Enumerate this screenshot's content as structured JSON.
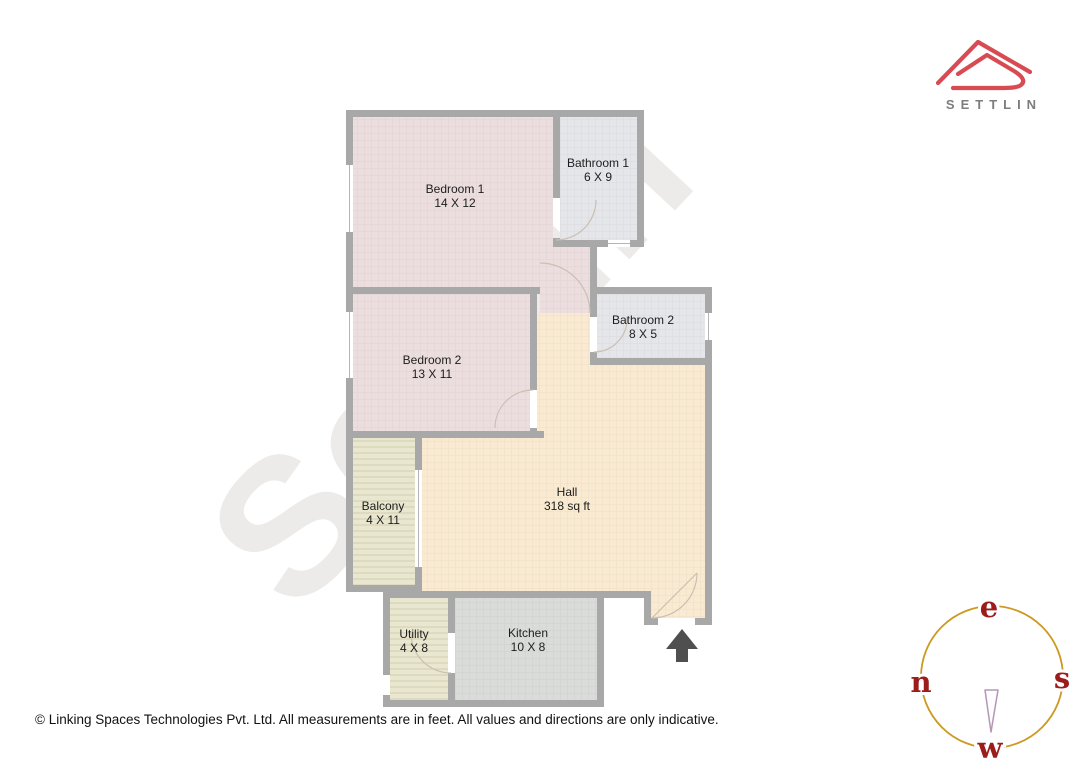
{
  "brand": {
    "name": "SETTLIN"
  },
  "watermark": "Settlin",
  "floorplan": {
    "rooms": [
      {
        "name": "Bedroom 1",
        "dims": "14 X 12"
      },
      {
        "name": "Bathroom 1",
        "dims": "6 X 9"
      },
      {
        "name": "Bedroom 2",
        "dims": "13 X 11"
      },
      {
        "name": "Bathroom 2",
        "dims": "8 X 5"
      },
      {
        "name": "Hall",
        "dims": "318 sq ft"
      },
      {
        "name": "Balcony",
        "dims": "4 X 11"
      },
      {
        "name": "Utility",
        "dims": "4 X 8"
      },
      {
        "name": "Kitchen",
        "dims": "10 X 8"
      }
    ]
  },
  "compass": {
    "top": "e",
    "left": "n",
    "right": "s",
    "bottom": "w"
  },
  "footer": {
    "note": "© Linking Spaces Technologies Pvt. Ltd. All measurements are in feet. All values and directions are only indicative."
  },
  "colors": {
    "wall": "#a8a8a8",
    "bedroom_fill": "#ecdede",
    "bathroom_fill": "#e5e6ea",
    "hall_fill": "#f9ead1",
    "balcony_fill": "#eae7d0",
    "kitchen_fill": "#d9dcd8",
    "logo_red": "#d84b52",
    "brand_gray": "#7d7d7d",
    "compass_ring": "#cc9a22",
    "compass_letter": "#9c1b1b",
    "needle_stroke": "#b596b5",
    "arrow": "#4f4f4f",
    "watermark": "#e8e6e4",
    "label_text": "#1d1d1d",
    "footer_text": "#111111"
  }
}
